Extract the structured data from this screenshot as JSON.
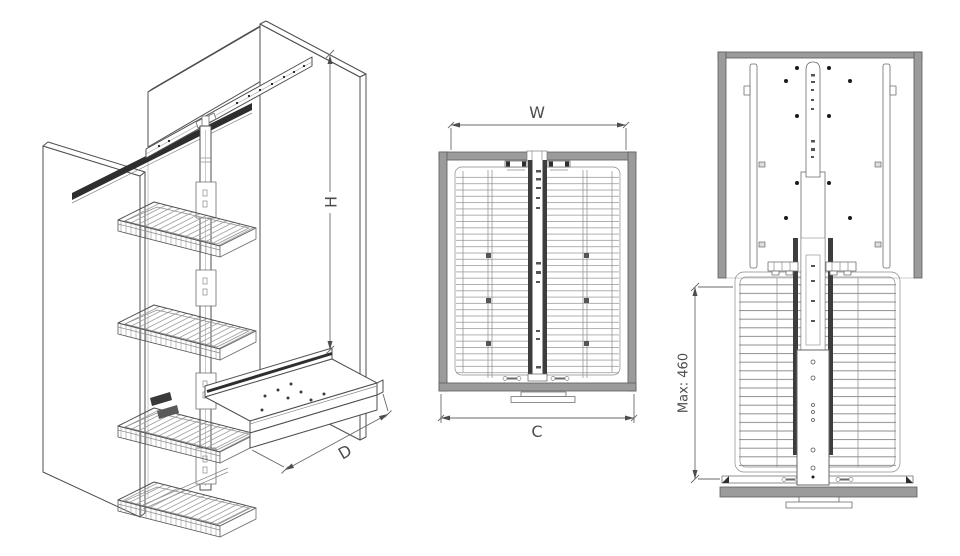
{
  "labels": {
    "height": "H",
    "depth": "D",
    "width": "W",
    "carcass_width": "C",
    "max_extension": "Max: 460"
  },
  "colors": {
    "background": "#ffffff",
    "outline": "#4f4f4f",
    "panel_gray": "#9b9b9b",
    "rail_dark": "#2e2e2e",
    "wire_gray": "#9a9a9a",
    "dimension_text": "#4d4d4d"
  }
}
